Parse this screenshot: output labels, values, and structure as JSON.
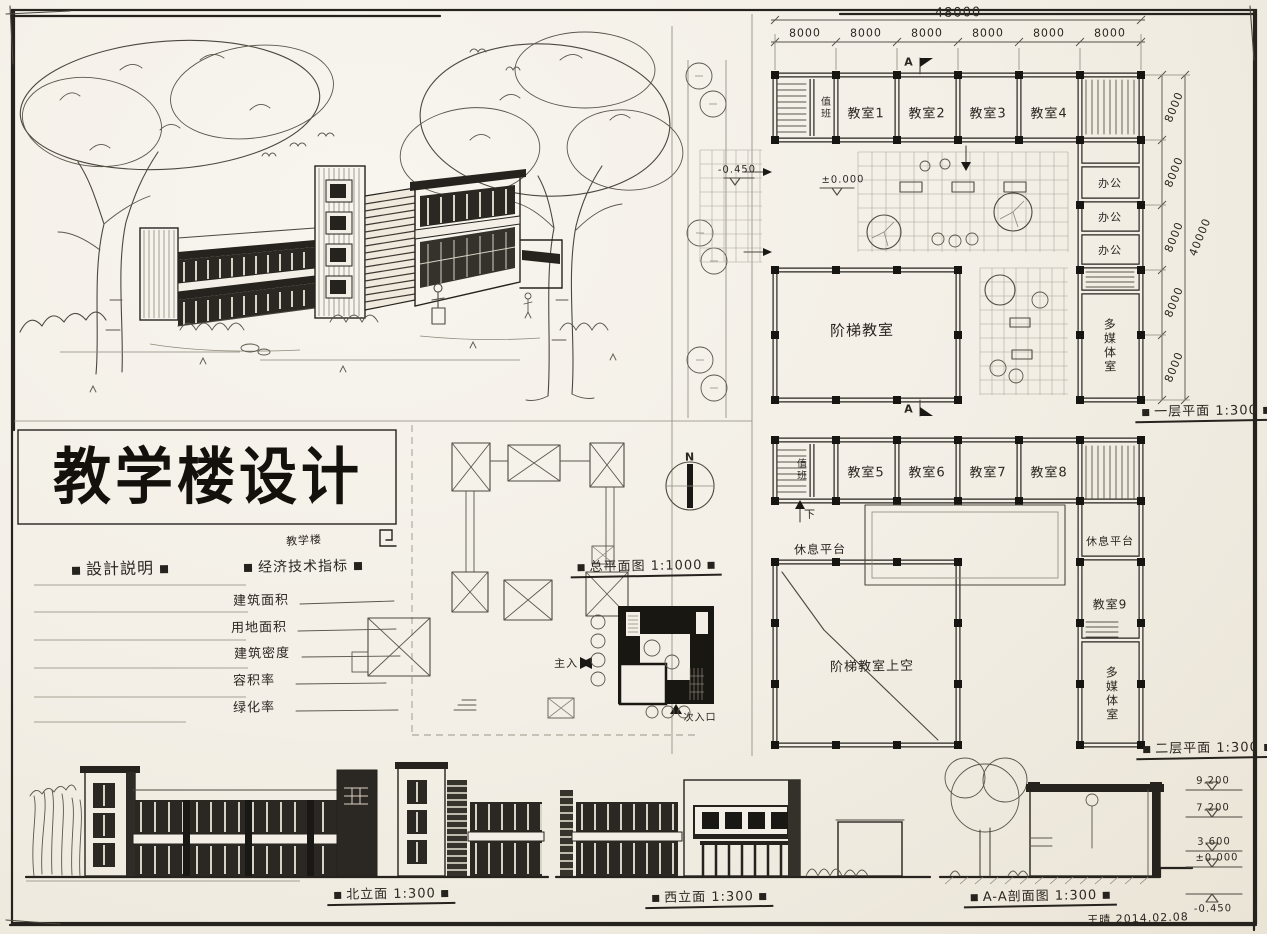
{
  "sheet": {
    "signature": "王晴 2014.02.08"
  },
  "title_block": {
    "title": "教学楼设计",
    "annotation": "教学楼",
    "notes_heading": "設計説明",
    "indicators_heading": "经济技术指标",
    "indicators": [
      "建筑面积",
      "用地面积",
      "建筑密度",
      "容积率",
      "绿化率"
    ]
  },
  "site_plan": {
    "caption": "总平面图 1:1000",
    "north": "N",
    "main_entrance": "主入",
    "secondary_entrance": "次入口"
  },
  "floor1": {
    "caption": "一层平面 1:300",
    "total_width": "48000",
    "total_depth": "40000",
    "bays": [
      "8000",
      "8000",
      "8000",
      "8000",
      "8000",
      "8000"
    ],
    "side_bays": [
      "8000",
      "8000",
      "8000",
      "8000",
      "8000"
    ],
    "section_mark": "A",
    "level_inside": "±0.000",
    "level_outside": "-0.450",
    "duty_room": "值班",
    "classrooms": [
      "教室1",
      "教室2",
      "教室3",
      "教室4"
    ],
    "offices": [
      "办公",
      "办公",
      "办公"
    ],
    "lecture_hall": "阶梯教室",
    "multimedia_room": "多媒体室"
  },
  "floor2": {
    "caption": "二层平面 1:300",
    "duty_room": "值班",
    "classrooms": [
      "教室5",
      "教室6",
      "教室7",
      "教室8"
    ],
    "classroom9": "教室9",
    "rest_platform_left": "休息平台",
    "rest_platform_right": "休息平台",
    "void_label": "阶梯教室上空",
    "multimedia_room": "多媒体室",
    "down_label": "下"
  },
  "elevations": {
    "north_caption": "北立面 1:300",
    "west_caption": "西立面 1:300",
    "section_caption": "A-A剖面图 1:300",
    "levels": [
      "9.200",
      "7.200",
      "3.600",
      "±0.000",
      "-0.450"
    ]
  }
}
